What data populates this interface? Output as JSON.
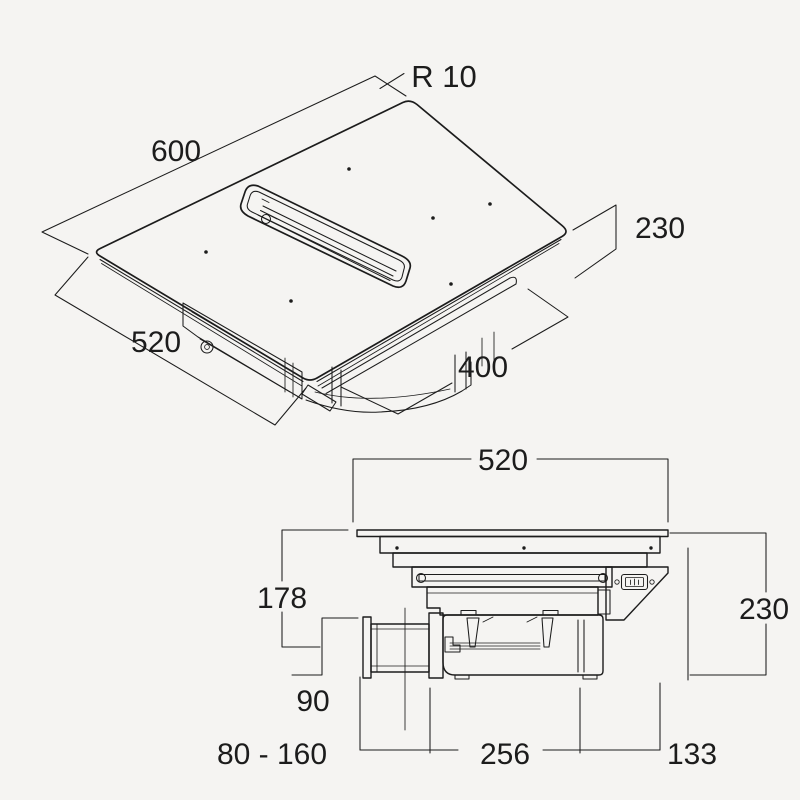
{
  "colors": {
    "background": "#f5f4f2",
    "ink": "#1c1c1c"
  },
  "iso": {
    "corner_radius": "R 10",
    "width": "600",
    "depth": "520",
    "outlet_length": "400",
    "height": "230"
  },
  "side": {
    "width": "520",
    "surface_to_duct_axis": "178",
    "height": "230",
    "duct_diameter": "90",
    "duct_stub_range": "80 - 160",
    "motor_length": "256",
    "edge_offset": "133"
  }
}
